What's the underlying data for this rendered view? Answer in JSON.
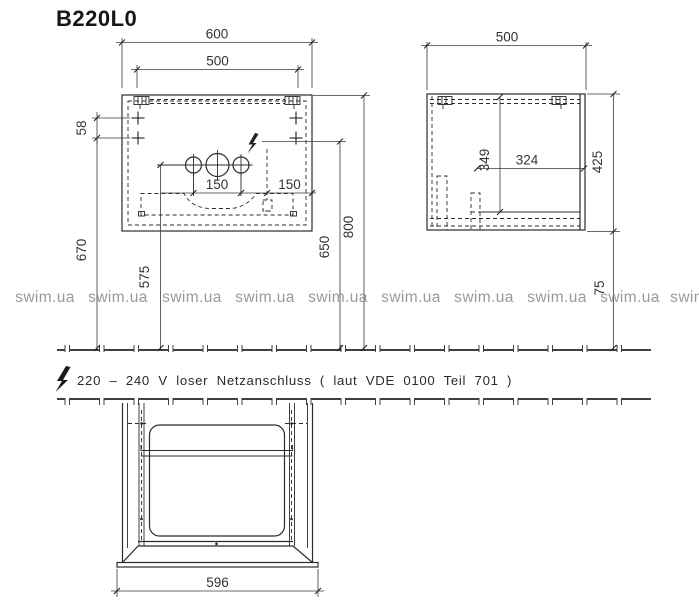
{
  "title": "B220L0",
  "watermark": {
    "text": "swim.ua"
  },
  "note": {
    "icon": "lightning-bolt",
    "text": "220 – 240 V loser Netzanschluss ( laut VDE 0100 Teil 701 )"
  },
  "front_view": {
    "dim_width_total": "600",
    "dim_width_hangers": "500",
    "dim_hanger_vertical_spacing": "58",
    "dim_tap_hole_spacing": "150",
    "dim_power_offset_from_edge": "150",
    "dim_height_fixing_holes": "670",
    "dim_height_tap_holes": "575",
    "dim_height_power_connection": "650",
    "dim_height_top_edge": "800"
  },
  "side_view": {
    "dim_depth": "500",
    "dim_inner_height": "349",
    "dim_inner_depth": "324",
    "dim_body_height": "425",
    "dim_floor_clearance": "75"
  },
  "plan_view": {
    "dim_width": "596"
  }
}
